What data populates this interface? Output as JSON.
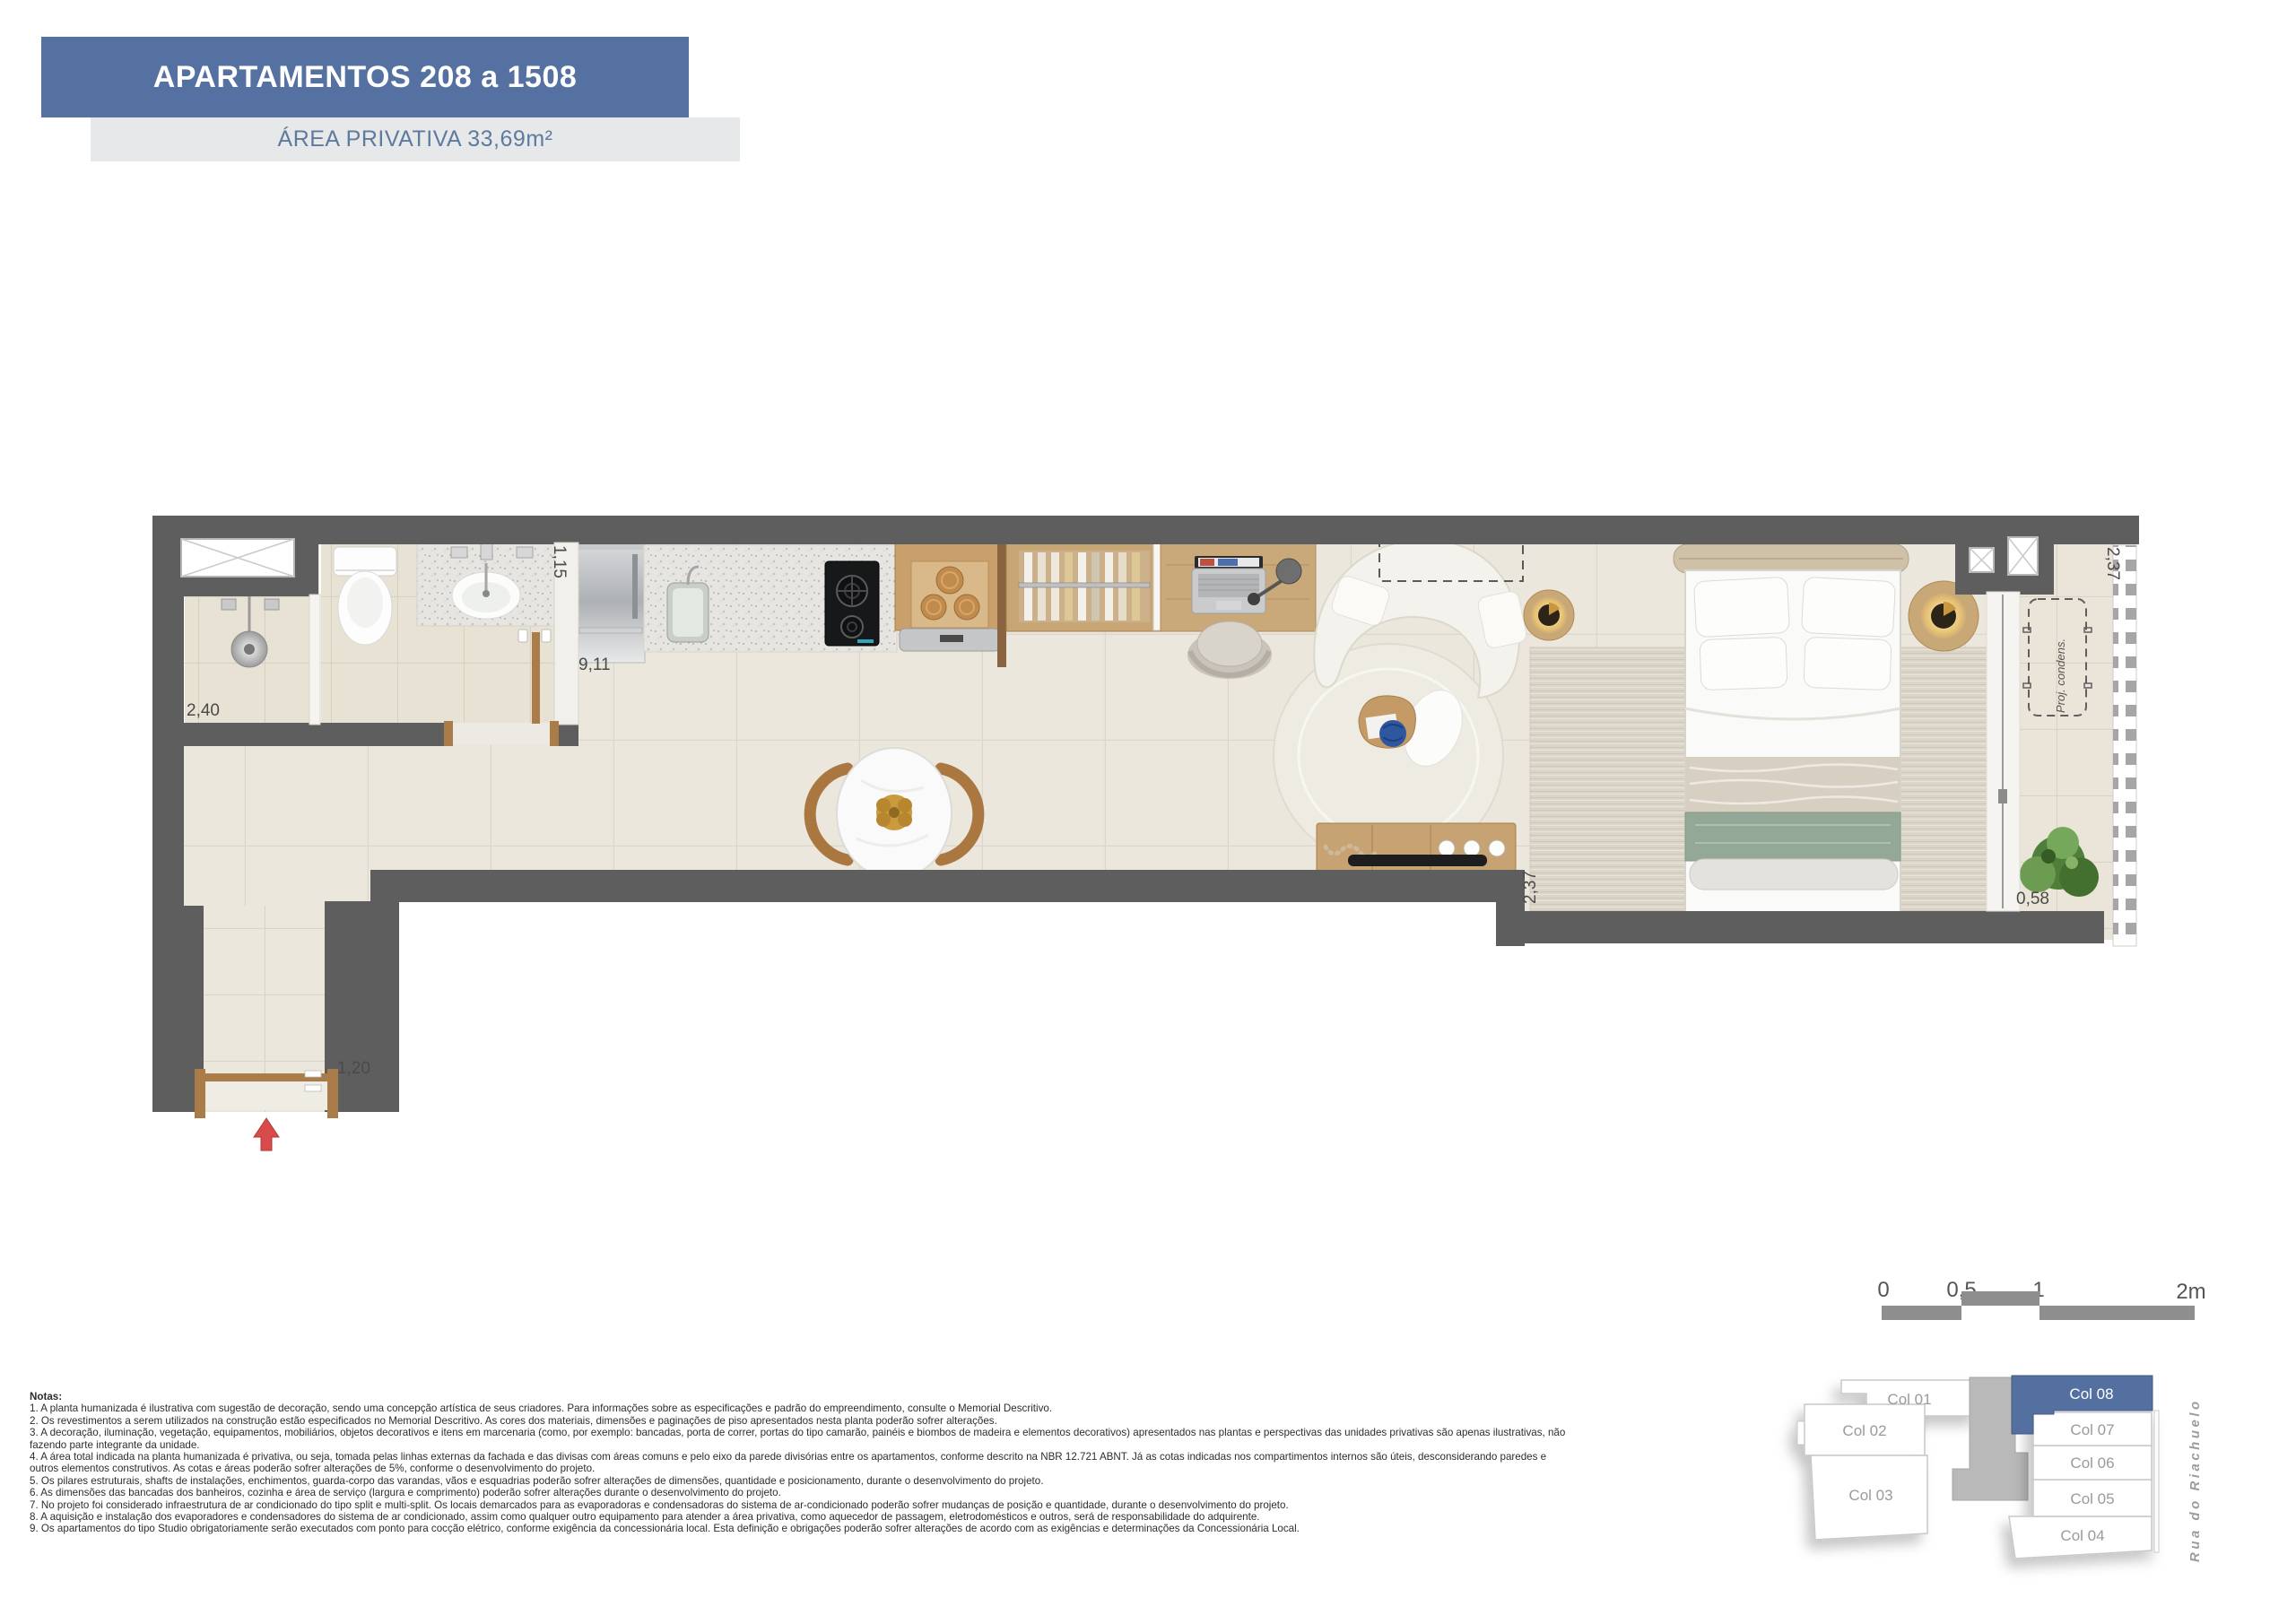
{
  "header": {
    "title": "APARTAMENTOS 208 a 1508",
    "subtitle": "ÁREA PRIVATIVA 33,69m²"
  },
  "plan": {
    "dimensions": {
      "shower": "2,40",
      "bath_counter": "1,15",
      "kitchen_run": "9,11",
      "bedroom_depth": "2,37",
      "balcony_depth": "2,37",
      "balcony_width": "0,58",
      "entry": "1,20"
    },
    "labels": {
      "condenser": "Proj. condens."
    }
  },
  "scalebar": {
    "ticks": [
      "0",
      "0,5",
      "1",
      "2m"
    ]
  },
  "keyplan": {
    "columns": [
      "Col 01",
      "Col 02",
      "Col 03",
      "Col 04",
      "Col 05",
      "Col 06",
      "Col 07",
      "Col 08"
    ],
    "highlighted": "Col 08",
    "street": "Rua do Riachuelo"
  },
  "notes": {
    "title": "Notas:",
    "items": [
      "1. A planta humanizada é ilustrativa com sugestão de decoração, sendo uma concepção artística de seus criadores. Para informações sobre as especificações e padrão do empreendimento, consulte o Memorial Descritivo.",
      "2. Os revestimentos a serem utilizados na construção estão especificados no Memorial Descritivo. As cores dos materiais, dimensões e paginações de piso apresentados nesta planta poderão sofrer alterações.",
      "3. A decoração, iluminação, vegetação, equipamentos, mobiliários, objetos decorativos e itens em marcenaria (como, por exemplo: bancadas, porta de correr, portas do tipo camarão, painéis e biombos de madeira e elementos decorativos) apresentados nas plantas e perspectivas das unidades privativas são apenas ilustrativas, não fazendo parte integrante da unidade.",
      "4. A área total indicada na planta humanizada é privativa, ou seja, tomada pelas linhas externas da fachada e das divisas com áreas comuns e pelo eixo da parede divisórias entre os apartamentos, conforme descrito na NBR 12.721 ABNT. Já as cotas indicadas nos compartimentos internos são úteis, desconsiderando paredes e outros elementos construtivos. As cotas e áreas poderão sofrer alterações de 5%, conforme o desenvolvimento do projeto.",
      "5. Os pilares estruturais, shafts de instalações, enchimentos, guarda-corpo das varandas, vãos e esquadrias poderão sofrer alterações de dimensões, quantidade e posicionamento, durante o desenvolvimento do projeto.",
      "6. As dimensões das bancadas dos banheiros, cozinha e área de serviço (largura e comprimento) poderão sofrer alterações durante o desenvolvimento do projeto.",
      "7. No projeto foi considerado infraestrutura de ar condicionado do tipo split e multi-split. Os locais demarcados para as evaporadoras e condensadoras do sistema de ar-condicionado poderão sofrer mudanças de posição e quantidade, durante o desenvolvimento do projeto.",
      "8. A aquisição e instalação dos evaporadores e condensadores do sistema de ar condicionado, assim como qualquer outro equipamento para atender a área privativa, como aquecedor de passagem, eletrodomésticos e outros, será de responsabilidade do adquirente.",
      "9. Os apartamentos do tipo Studio obrigatoriamente serão executados com ponto para cocção elétrico, conforme exigência da concessionária local. Esta definição e obrigações poderão sofrer alterações de acordo com as exigências e determinações da Concessionária Local."
    ]
  },
  "colors": {
    "accent_blue": "#5571a2",
    "wall_gray": "#5e5e5e",
    "floor_beige": "#ebe7dc",
    "arrow_red": "#d84b4b"
  }
}
